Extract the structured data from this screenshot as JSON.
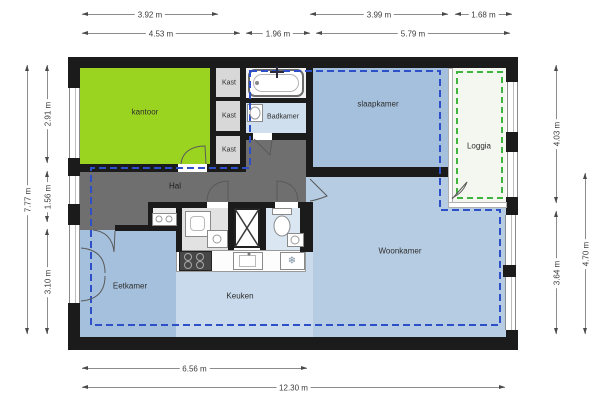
{
  "rooms": {
    "kantoor": "kantoor",
    "kast1": "Kast",
    "kast2": "Kast",
    "kast3": "Kast",
    "badkamer": "Badkamer",
    "slaapkamer": "slaapkamer",
    "loggia": "Loggia",
    "hal": "Hal",
    "eetkamer": "Eetkamer",
    "keuken": "Keuken",
    "woonkamer": "Woonkamer"
  },
  "dims": {
    "w_kantoor": "3.92 m",
    "w_slaapkamer": "3.99 m",
    "w_loggia": "1.68 m",
    "w_kantoor_kast": "4.53 m",
    "w_badkamer": "1.96 m",
    "w_woon_right": "5.79 m",
    "h_total": "7.77 m",
    "h_kantoor": "2.91 m",
    "h_hal": "1.56 m",
    "h_eetkamer": "3.10 m",
    "h_slaap_loggia": "4.03 m",
    "h_woonkamer": "3.64 m",
    "h_woon_outer": "4.70 m",
    "w_bottom_left": "6.56 m",
    "w_total": "12.30 m"
  },
  "colors": {
    "kantoor": "#9ad420",
    "slaapkamer": "#a5c0dc",
    "eetkamer": "#a5c0dc",
    "woonkamer": "#b6cce3",
    "keuken": "#c8daec",
    "badkamer": "#d0dfee",
    "wc": "#dae6f2",
    "hal": "#6f6f6f",
    "kast": "#d8d8d8",
    "tub_room": "#f2f2f2",
    "tiny_room": "#ededed",
    "washer_room": "#e2e2e2",
    "loggia": "#f4f7ef",
    "dash_blue": "#2d50c8",
    "dash_green": "#3fb53f"
  },
  "icons": {
    "snowflake": "❄"
  }
}
